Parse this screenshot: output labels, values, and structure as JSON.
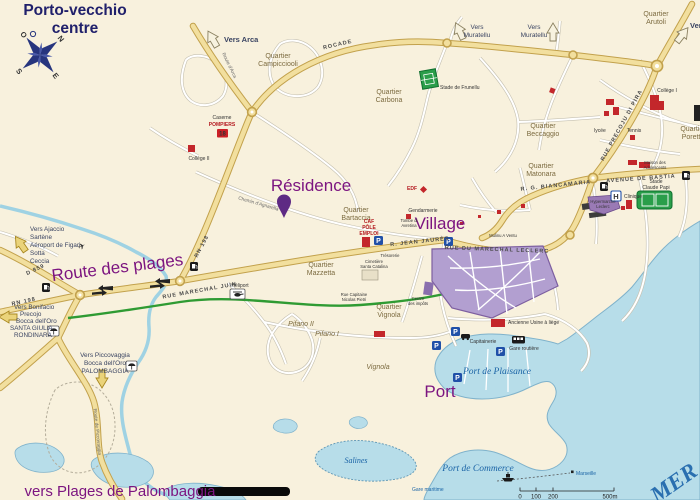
{
  "title": {
    "line1": "Porto-vecchio",
    "line2": "centre"
  },
  "compass": {
    "n": "N",
    "e": "E",
    "s": "S",
    "o": "O"
  },
  "major": {
    "residence": "Résidence",
    "village": "Village",
    "port": "Port",
    "route_des_plages": "Route des plages",
    "vers_palombaggia": "vers Plages de Palombaggia"
  },
  "water": {
    "plaisance": "Port de Plaisance",
    "commerce": "Port de Commerce",
    "salines": "Salines",
    "mer": "MER",
    "gare_maritime": "Gare maritime",
    "marseille": "Marseille"
  },
  "directions": {
    "arca": "Vers Arca",
    "muratellu1_l1": "Vers",
    "muratellu1_l2": "Muratellu",
    "muratellu2_l1": "Vers",
    "muratellu2_l2": "Muratellu",
    "ne": "Vers",
    "ajaccio": [
      "Vers Ajaccio",
      "Sartène",
      "Aéroport de Figari",
      "Sotta",
      "Ceccia"
    ],
    "bonifacio": [
      "Vers Bonifacio",
      "Precojo",
      "Bocca dell'Oro",
      "SANTA GIULIA",
      "RONDINARA"
    ],
    "piccovaggia": [
      "Vers Piccovaggia",
      "Bocca dell'Oro",
      "PALOMBAGGIA"
    ]
  },
  "quartiers": {
    "campicciooli_l1": "Quartier",
    "campicciooli_l2": "Campicciooli",
    "carbona_l1": "Quartier",
    "carbona_l2": "Carbona",
    "arutoli_l1": "Quartier",
    "arutoli_l2": "Arutoli",
    "beccaggio_l1": "Quartier",
    "beccaggio_l2": "Beccaggio",
    "matonara_l1": "Quartier",
    "matonara_l2": "Matonara",
    "poretta_l1": "Quartier",
    "poretta_l2": "Poretta",
    "bartaccia_l1": "Quartier",
    "bartaccia_l2": "Bartaccia",
    "mazzetta_l1": "Quartier",
    "mazzetta_l2": "Mazzetta",
    "vignola_l1": "Quartier",
    "vignola_l2": "Vignola",
    "vignola_it": "Vignola",
    "pifano1": "Pifano I",
    "pifano2": "Pifano II"
  },
  "streets": {
    "rocade": "ROCADE",
    "rn198_sw": "RN 198",
    "rn198_mid": "RN 198",
    "d859": "D 859",
    "juin": "RUE MARECHAL JUIN",
    "jaures": "R. JEAN JAURÈS",
    "leclerc": "RUE DU MARECHAL LECLERC",
    "bastia": "AVENUE DE BASTIA",
    "biancamaria": "R. G. BIANCAMARIA",
    "precoju": "RUE PRECOJU DI PIRA",
    "piccovaggia": "Route de Piccovaggia",
    "agnarella": "Chemin d'Agnarella",
    "arca": "Route d'Arca"
  },
  "pois": {
    "caserne_l1": "Caserne",
    "caserne_l2": "POMPIERS",
    "college2": "Collège II",
    "frunellu": "Stade de Frunellu",
    "college1": "Collège I",
    "lycee": "lycée",
    "tennis": "Tennis",
    "maison_l1": "Maison des",
    "maison_l2": "Adolescents",
    "papi_l1": "Stade",
    "papi_l2": "Claude Papi",
    "clinique": "Clinique",
    "hyper_l1": "Hypermarché",
    "hyper_l2": "Leclerc",
    "edf": "EDF",
    "gendarmerie": "Gendarmerie",
    "tombe_l1": "Tombe di",
    "tombe_l2": "Avretina",
    "caf_l1": "CAF",
    "caf_l2": "PÔLE",
    "caf_l3": "EMPLOI",
    "tresorerie": "Trésorerie",
    "cimetiere_l1": "Cimetière",
    "cimetiere_l2": "Santa Catalina",
    "heliport": "Héliport",
    "usine": "Ancienne Usine à liège",
    "capitainerie": "Capitainerie",
    "gare_routiere": "Gare routière",
    "impots_l1": "Centre",
    "impots_l2": "des impôts",
    "capitaine_l1": "Rue Capitaine",
    "capitaine_l2": "Nicolas Pietri",
    "mulinu": "Mulinu A Ventu"
  },
  "icons": {
    "parking": "P",
    "hospital": "H",
    "fire_station": "18",
    "plane": "✈"
  },
  "scale": {
    "t0": "0",
    "t100": "100",
    "t200": "200",
    "t500": "500m"
  },
  "colors": {
    "land": "#f8f1dd",
    "sea": "#b7dde9",
    "main_road": "#f2df9e",
    "accent_purple": "#7c1580",
    "building_red": "#c3272b",
    "old_town": "#b29fd0",
    "green_route": "#2f9b33",
    "stadium": "#2a9e4a"
  }
}
